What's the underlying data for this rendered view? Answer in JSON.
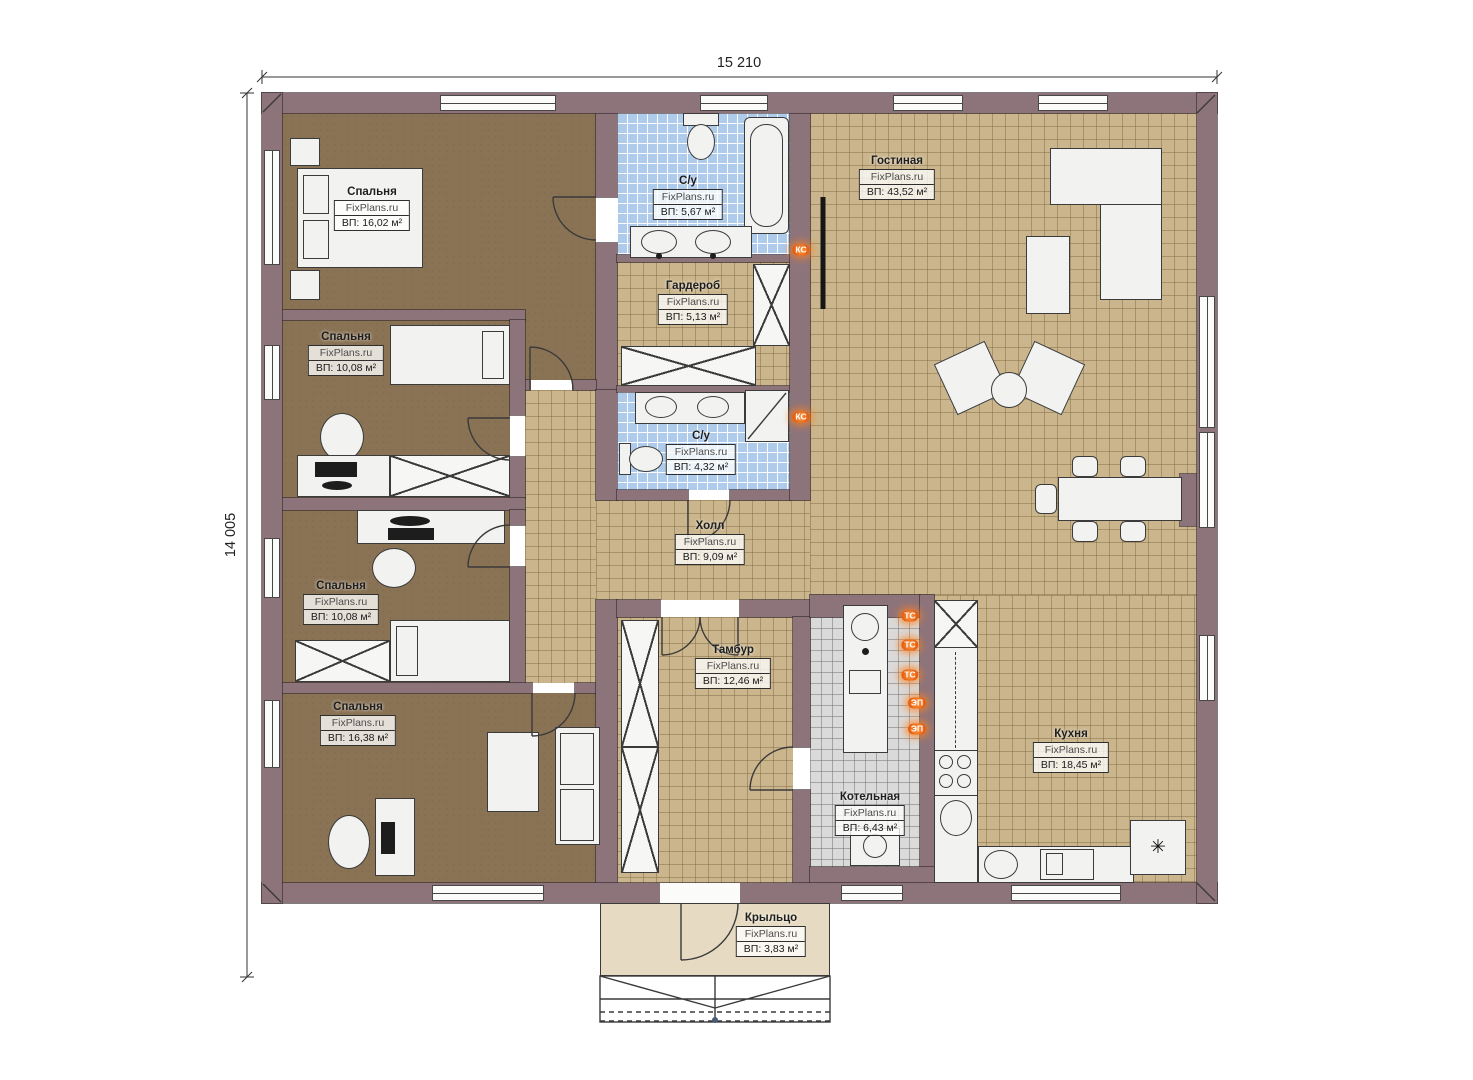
{
  "dimensions": {
    "width_label": "15 210",
    "height_label": "14 005"
  },
  "brand": "FixPlans.ru",
  "rooms": {
    "bedroom1": {
      "name": "Спальня",
      "area": "ВП: 16,02 м²"
    },
    "bedroom2": {
      "name": "Спальня",
      "area": "ВП: 10,08 м²"
    },
    "bedroom3": {
      "name": "Спальня",
      "area": "ВП: 10,08 м²"
    },
    "bedroom4": {
      "name": "Спальня",
      "area": "ВП: 16,38 м²"
    },
    "bath1": {
      "name": "С/у",
      "area": "ВП: 5,67 м²"
    },
    "bath2": {
      "name": "С/у",
      "area": "ВП: 4,32 м²"
    },
    "wardrobe": {
      "name": "Гардероб",
      "area": "ВП: 5,13 м²"
    },
    "living": {
      "name": "Гостиная",
      "area": "ВП: 43,52 м²"
    },
    "hall": {
      "name": "Холл",
      "area": "ВП: 9,09 м²"
    },
    "tambour": {
      "name": "Тамбур",
      "area": "ВП: 12,46 м²"
    },
    "boiler": {
      "name": "Котельная",
      "area": "ВП: 6,43 м²"
    },
    "kitchen": {
      "name": "Кухня",
      "area": "ВП: 18,45 м²"
    },
    "porch": {
      "name": "Крыльцо",
      "area": "ВП: 3,83 м²"
    }
  },
  "utility_markers": {
    "ks1": "КС",
    "ks2": "КС",
    "ts1": "ТС",
    "ts2": "ТС",
    "ts3": "ТС",
    "ep1": "ЭП",
    "ep2": "ЭП"
  },
  "symbols": {
    "fridge": "✳"
  },
  "colors": {
    "wall": "#8d747b",
    "bedroom_floor": "#8a7355",
    "tile_floor": "#cbb58c",
    "bath_tile": "#aecbec",
    "boiler_floor": "#dadada",
    "porch_floor": "#e6dbc2",
    "marker_orange": "#e8600f"
  }
}
